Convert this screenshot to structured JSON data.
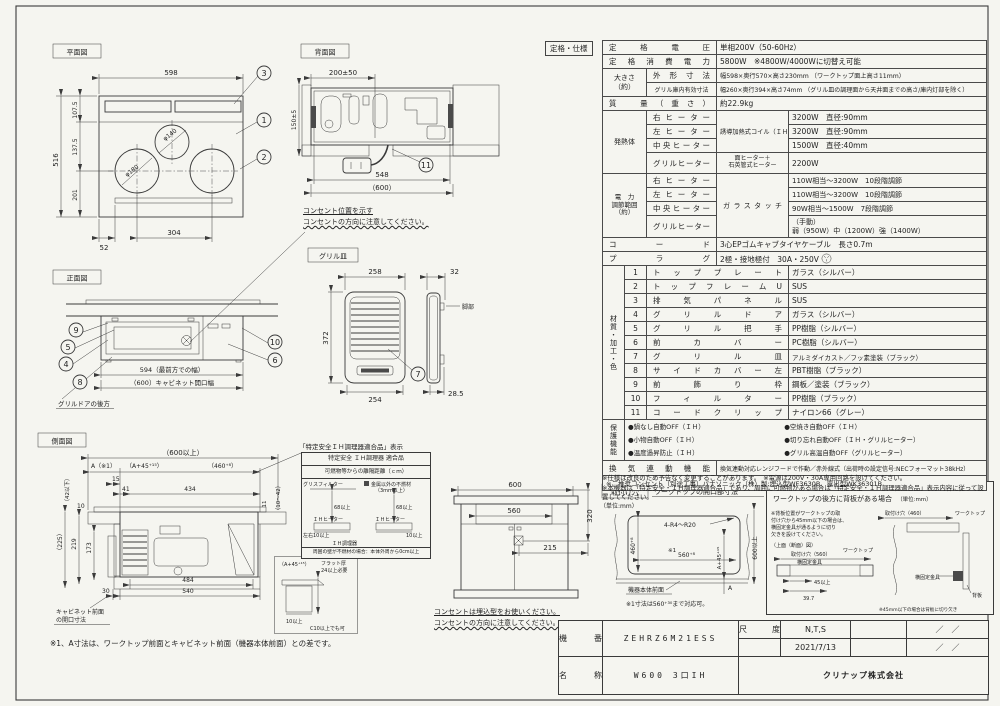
{
  "plan": {
    "label": "平面図",
    "d_width": "598",
    "d_depth": "516",
    "d_107": "107.5",
    "d_137": "137.5",
    "d_201": "201",
    "d_52": "52",
    "d_304": "304",
    "phi_center": "φ140",
    "phi_left": "φ180",
    "c1": "1",
    "c2": "2",
    "c3": "3"
  },
  "rear": {
    "label": "背面図",
    "d_200": "200±50",
    "d_150": "150±5",
    "d_548": "548",
    "d_600": "（600）",
    "c11": "11",
    "note1": "コンセント位置を示す",
    "note2": "コンセントの方向に注意してください。"
  },
  "front": {
    "label": "正面図",
    "d_594": "594（最前方での幅）",
    "d_600": "（600）キャビネット開口幅",
    "c4": "4",
    "c5": "5",
    "c6": "6",
    "c8": "8",
    "c9": "9",
    "c10": "10",
    "note": "グリルドアの後方"
  },
  "grill": {
    "label": "グリル皿",
    "d_258": "258",
    "d_372": "372",
    "d_254": "254",
    "d_32": "32",
    "d_285": "28.5",
    "leg": "脚部",
    "c7": "7"
  },
  "side": {
    "label": "側面図",
    "d_600": "（600以上）",
    "d_a": "A（※1）",
    "d_a45": "（A+45⁺¹⁵）",
    "d_460": "（460⁺⁸）",
    "d_15": "15",
    "d_41": "41",
    "d_434": "434",
    "d_42": "（42以下）",
    "d_10": "10",
    "d_225": "（225）",
    "d_219": "219",
    "d_173": "173",
    "d_11": "11",
    "d_1042": "（10～42）",
    "d_484": "484",
    "d_540": "540",
    "d_30": "30",
    "cab1": "キャビネット前面",
    "cab2": "の開口寸法",
    "fn": "※1、A寸法は、ワークトップ前面とキャビネット前面（機器本体前面）との差です。"
  },
  "flat": {
    "a45": "（A+45⁺¹⁵）",
    "t1": "フラット厚",
    "t2": "24以上必要",
    "d10": "10以上",
    "c10": "C10以上でも可"
  },
  "tokutei": {
    "title": "「特定安全ＩＨ調理器適合品」表示",
    "l1": "特定安全 ＩＨ調理器 適合品",
    "l2": "可燃物等からの離隔距離（ｃｍ）",
    "grease": "グリスフィルター",
    "noncomb1": "金属以外の不燃材",
    "noncomb2": "（3mm以上）",
    "d68a": "68以上",
    "d68b": "68以上",
    "lr10": "左右10以上",
    "r10": "10以上",
    "ih1": "ＩＨヒーター",
    "ih2": "ＩＨヒーター",
    "cooker": "ＩＨ調理器",
    "bottom": "周囲の壁が不燃材の場合：本体外周から0cm以上"
  },
  "cab": {
    "d_600": "600",
    "d_560": "560",
    "d_320": "320",
    "d_215": "215",
    "note1": "コンセントは埋込型をお使いください。",
    "note2": "コンセントの方向に注意してください。"
  },
  "mount": {
    "tag": "取付け穴",
    "title": "ワークトップの開口部寸法",
    "unit": "（単位:mm）",
    "radius": "4-R4～R20",
    "d_460": "460⁺⁸",
    "ref": "※1",
    "d_560": "560⁺⁸",
    "d_600": "600以上",
    "d_a45": "A+45⁺¹⁵",
    "d_a": "A",
    "front": "機器本体前面",
    "note": "※1寸法は560⁺³⁰まで対応可。"
  },
  "bb": {
    "title": "ワークトップの後方に背板がある場合",
    "unit": "（単位:mm）",
    "n1": "※背板位置がワークトップの取",
    "n2": "付け穴から45mm以下の場合は、",
    "n3": "横固定金具が通るように切り",
    "n4": "欠きを設けてください。",
    "sub": "（上面（断面）図）",
    "hole560": "取付け穴（560）",
    "hole460": "取付け穴（460）",
    "wt1": "ワークトップ",
    "wt2": "ワークトップ",
    "br1": "横固定金具",
    "br2": "横固定金具",
    "d45": "45以上",
    "d397": "39.7",
    "board": "背板",
    "n5": "※45mm以下の場合は背板に切り欠き"
  },
  "spec": {
    "tag": "定格・仕様",
    "rows": {
      "voltage": {
        "label": "定格電圧",
        "value": "単相200V（50-60Hz）"
      },
      "power": {
        "label": "定格消費電力",
        "value": "5800W　※4800W/4000Wに切替え可能"
      },
      "size": {
        "group": "大きさ\n（約）",
        "r1": {
          "label": "外形寸法",
          "value": "幅598×奥行570×高さ230mm （ワークトップ面上高さ11mm）"
        },
        "r2": {
          "label": "グリル庫内有効寸法",
          "value": "幅260×奥行394×高さ74mm （グリル皿の調理面から天井面までの高さ/庫内灯部を除く）"
        }
      },
      "mass": {
        "label": "質　量（重さ）",
        "value": "約22.9kg"
      },
      "heater": {
        "group": "発熱体",
        "type": "誘導加熱式コイル（ＩＨ）",
        "right": {
          "label": "右ヒーター",
          "value": "3200W　直径:90mm"
        },
        "left": {
          "label": "左ヒーター",
          "value": "3200W　直径:90mm"
        },
        "center": {
          "label": "中央ヒーター",
          "value": "1500W　直径:40mm"
        },
        "grill": {
          "label": "グリルヒーター",
          "type": "面ヒーター＋\n石英管式ヒーター",
          "value": "2200W"
        }
      },
      "range": {
        "group": "電　力\n調節範囲\n（約）",
        "type": "ガラスタッチ",
        "right": {
          "label": "右ヒーター",
          "value": "110W相当～3200W　10段階調節"
        },
        "left": {
          "label": "左ヒーター",
          "value": "110W相当～3200W　10段階調節"
        },
        "center": {
          "label": "中央ヒーター",
          "value": "90W相当～1500W　7段階調節"
        },
        "grill": {
          "label": "グリルヒーター",
          "value": "（手動）\n弱（950W）中（1200W）強（1400W）"
        }
      },
      "cord": {
        "label": "コード",
        "value": "3心EPゴムキャブタイヤケーブル　長さ0.7m"
      },
      "plug": {
        "label": "プラグ",
        "value": "2極・接地極付　30A・250V"
      },
      "materials": {
        "group": "材質・加工・色",
        "rows": [
          {
            "n": "1",
            "name": "トッププレート",
            "value": "ガラス（シルバー）"
          },
          {
            "n": "2",
            "name": "トップフレームU",
            "value": "SUS"
          },
          {
            "n": "3",
            "name": "排気パネル",
            "value": "SUS"
          },
          {
            "n": "4",
            "name": "グリルドア",
            "value": "ガラス（シルバー）"
          },
          {
            "n": "5",
            "name": "グリル把手",
            "value": "PP樹脂（シルバー）"
          },
          {
            "n": "6",
            "name": "前カバー",
            "value": "PC樹脂（シルバー）"
          },
          {
            "n": "7",
            "name": "グリル皿",
            "value": "アルミダイカスト／フッ素塗装（ブラック）"
          },
          {
            "n": "8",
            "name": "サイドカバー左",
            "value": "PBT樹脂（ブラック）"
          },
          {
            "n": "9",
            "name": "前飾り枠",
            "value": "鋼板／塗装（ブラック）"
          },
          {
            "n": "10",
            "name": "フィルター",
            "value": "PP樹脂（ブラック）"
          },
          {
            "n": "11",
            "name": "コードクリップ",
            "value": "ナイロン66（グレー）"
          }
        ]
      },
      "protect": {
        "group": "保護機能",
        "l": [
          "●鍋なし自動OFF（ＩＨ）",
          "●小物自動OFF（ＩＨ）",
          "●温度過昇防止（ＩＨ）"
        ],
        "r": [
          "●空焼き自動OFF（ＩＨ）",
          "●切り忘れ自動OFF（ＩＨ・グリルヒーター）",
          "●グリル高温自動OFF（グリルヒーター）"
        ]
      },
      "vent": {
        "label": "換気連動機能",
        "value": "換気連動対応レンジフードで作動／赤外線式（出荷時の設定信号:NECフォーマット38kHz）"
      },
      "outlet": "※ご推奨コンセント（別途工事）パナソニック（株）製:埋込型WF3630B、露出型WK36301B"
    },
    "notes": [
      "※仕様は改良のため予告なく変更することがあります。　※電源は200V・30A専用回路を設けてください。",
      "※本機器は「特定安全・ＩＨ調理器適合品」であり、周囲に可燃物がある場合は「特定安全・ＩＨ調理器適合品」表示内容に従って設置してください。"
    ]
  },
  "tb": {
    "kiban_label": "機　番",
    "kiban": "ZEHRZ6M21ESS",
    "meisho_label": "名　称",
    "meisho": "W600 3口IH",
    "scale_label": "尺　度",
    "scale": "N,T,S",
    "date": "2021/7/13",
    "slash1": "／　／",
    "slash2": "／　／",
    "company": "クリナップ株式会社"
  }
}
